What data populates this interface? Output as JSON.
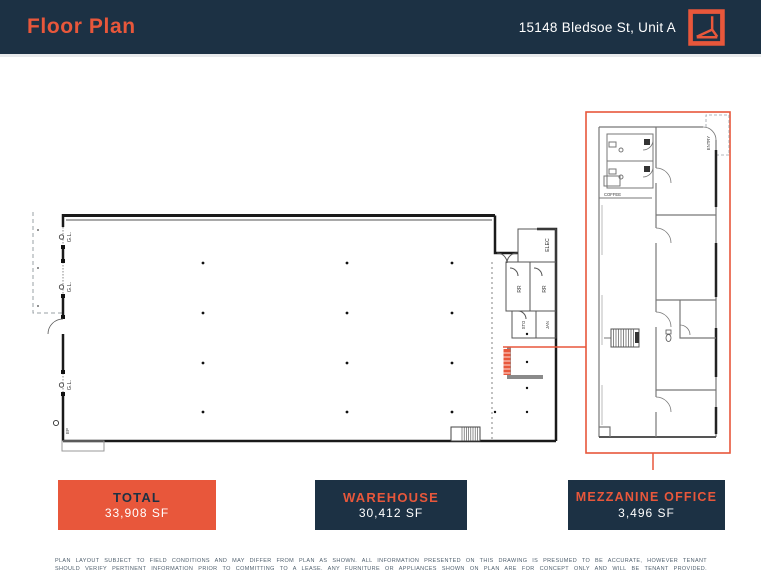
{
  "header": {
    "title": "Floor Plan",
    "address": "15148 Bledsoe St, Unit A"
  },
  "colors": {
    "navy": "#1c3144",
    "orange": "#e8573b"
  },
  "plan": {
    "warehouse_labels": {
      "gl": "G.L.",
      "elec": "ELEC",
      "rr": "RR",
      "sto": "STO",
      "jan": "JAN",
      "ep": "EP"
    },
    "mezzanine_labels": {
      "coffee": "COFFEE",
      "entry": "ENTRY"
    }
  },
  "summary_boxes": [
    {
      "label": "TOTAL",
      "value": "33,908 SF"
    },
    {
      "label": "WAREHOUSE",
      "value": "30,412 SF"
    },
    {
      "label": "MEZZANINE OFFICE",
      "value": "3,496 SF"
    }
  ],
  "disclaimer": {
    "line1": "PLAN LAYOUT SUBJECT TO FIELD CONDITIONS AND MAY DIFFER FROM PLAN AS SHOWN. ALL INFORMATION PRESENTED ON THIS DRAWING IS PRESUMED TO BE ACCURATE, HOWEVER TENANT",
    "line2": "SHOULD VERIFY PERTINENT INFORMATION PRIOR TO COMMITTING TO A LEASE. ANY FURNITURE OR APPLIANCES SHOWN ON PLAN ARE FOR CONCEPT ONLY AND WILL BE TENANT PROVIDED."
  }
}
